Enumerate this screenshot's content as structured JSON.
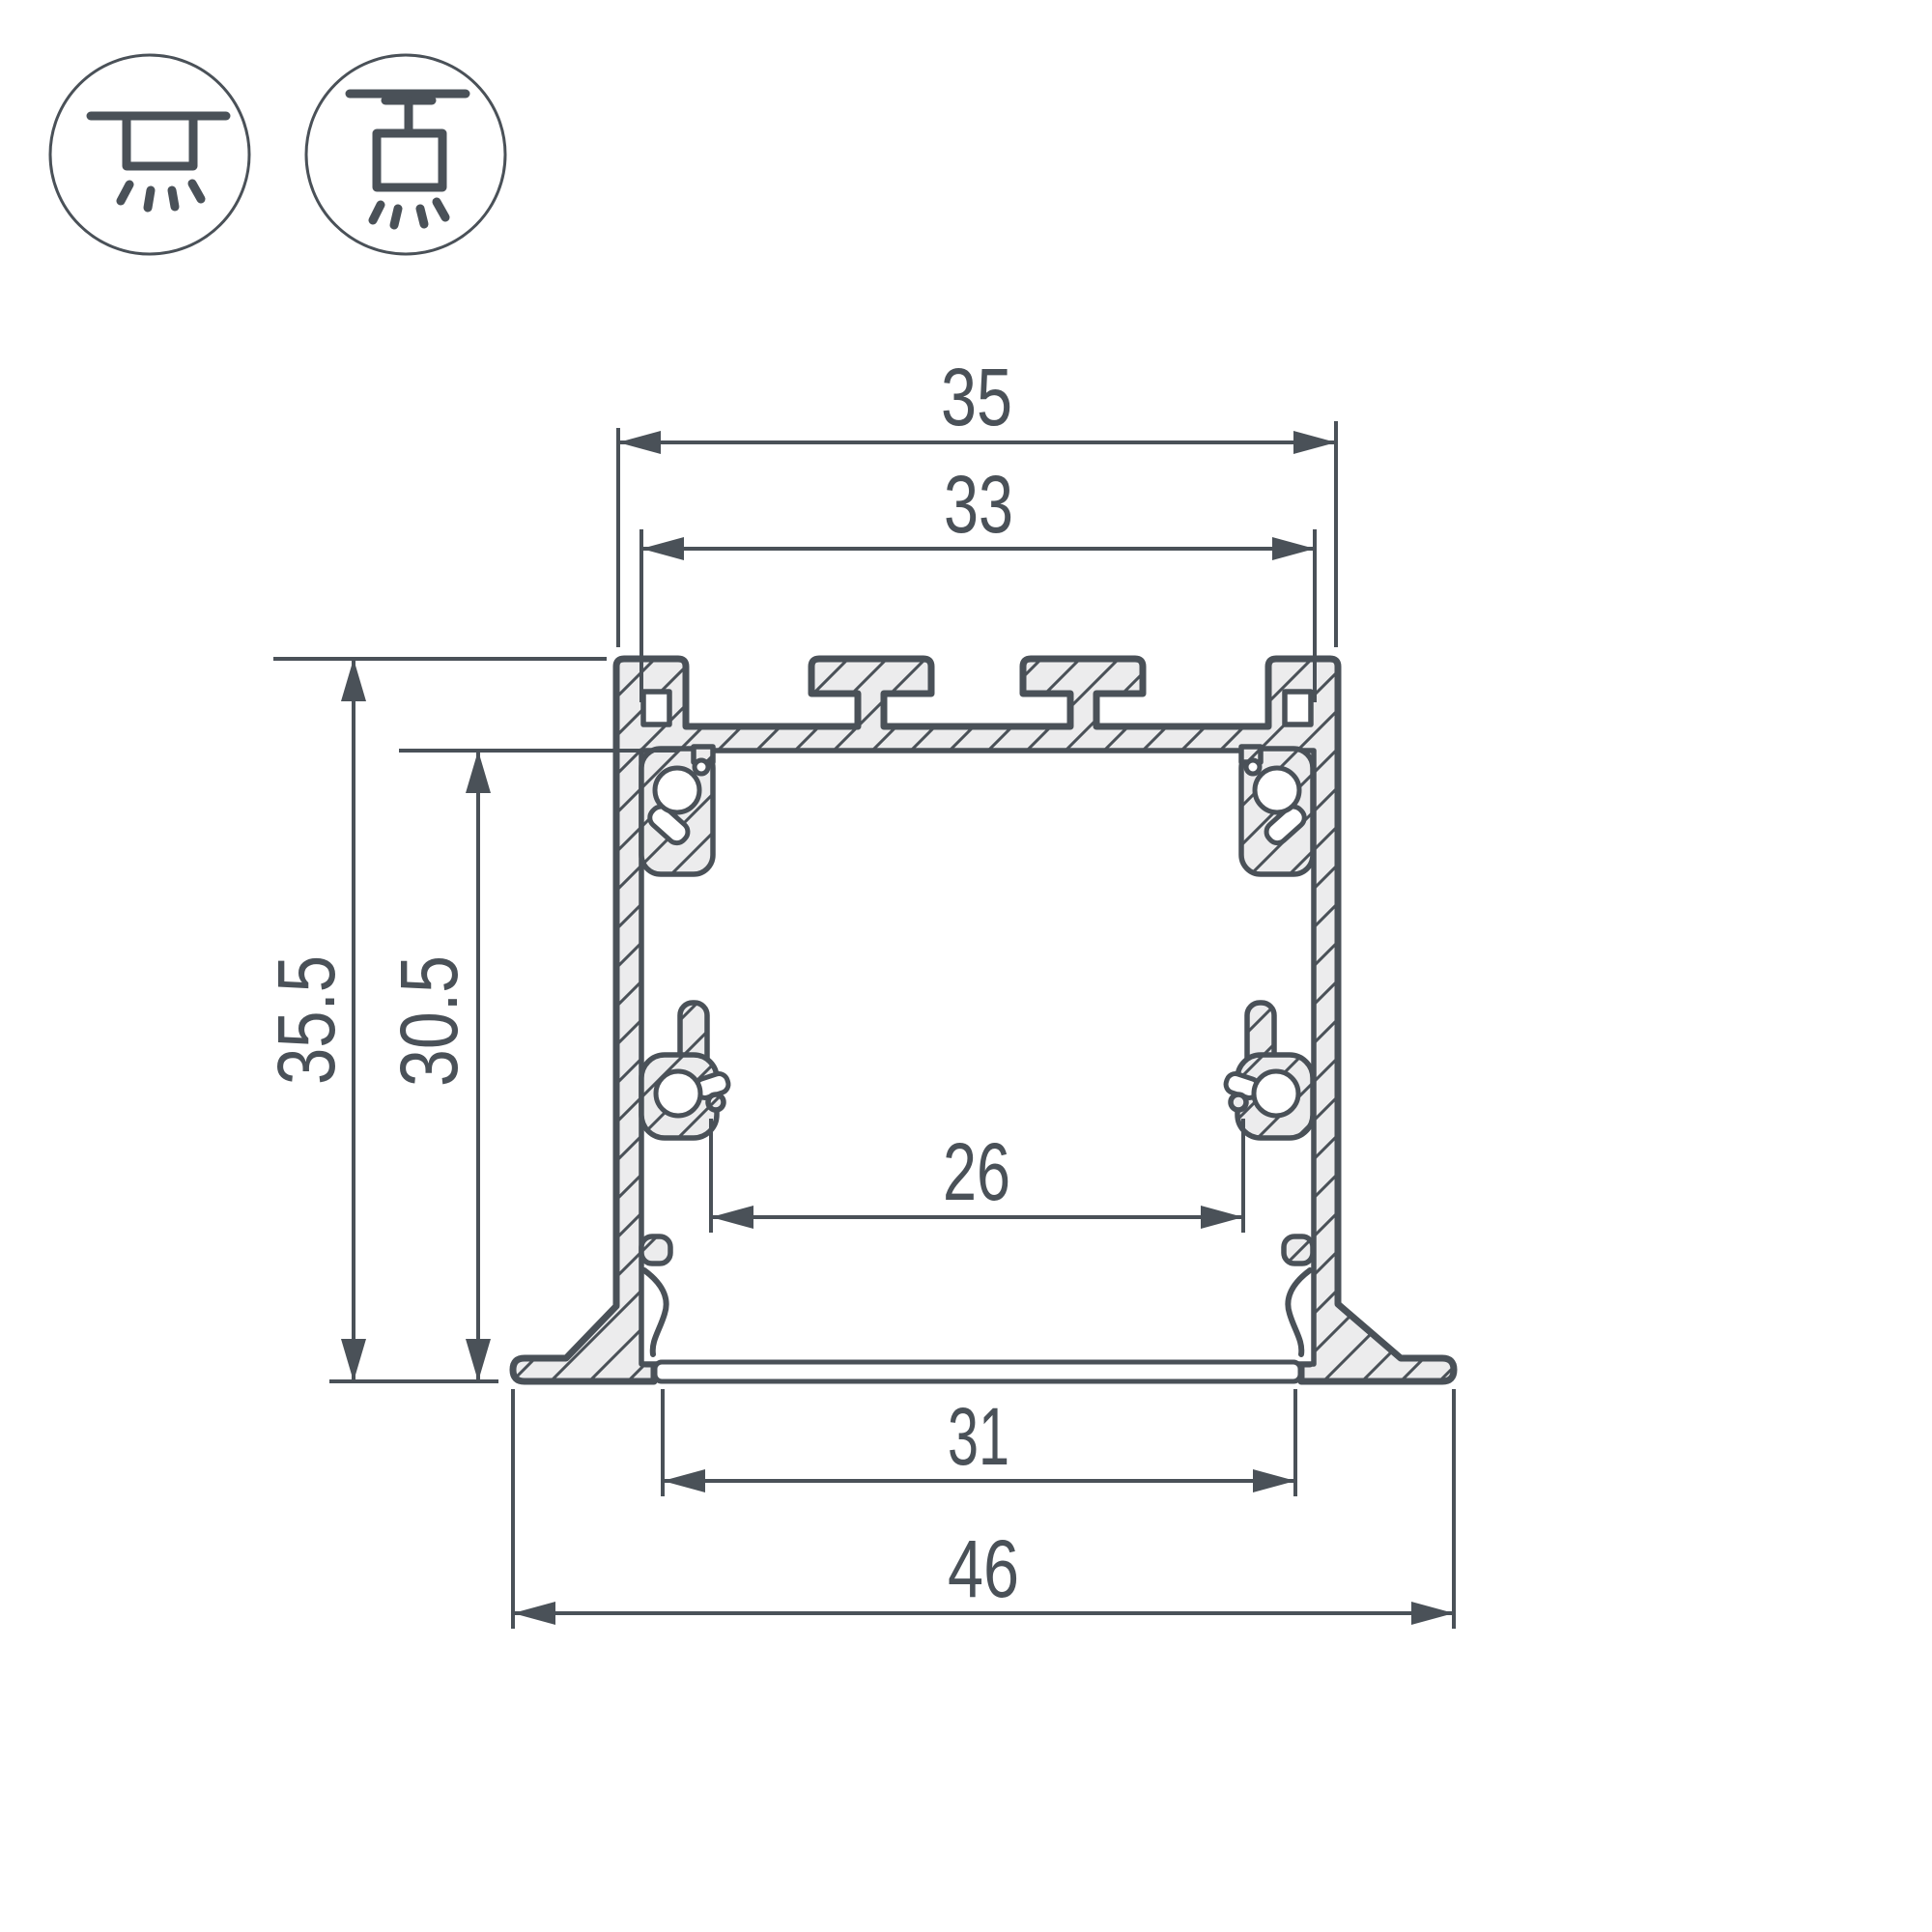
{
  "colors": {
    "line": "#4a5158",
    "aluminum": "#ececed",
    "white": "#ffffff"
  },
  "icons": {
    "first": "recessed-mount",
    "second": "surface-mount"
  },
  "dimensions": {
    "top_outer_width": "35",
    "top_inner_width": "33",
    "overall_height": "35.5",
    "inner_height": "30.5",
    "inner_bottom_width": "26",
    "bottom_opening_width": "31",
    "overall_width": "46"
  }
}
